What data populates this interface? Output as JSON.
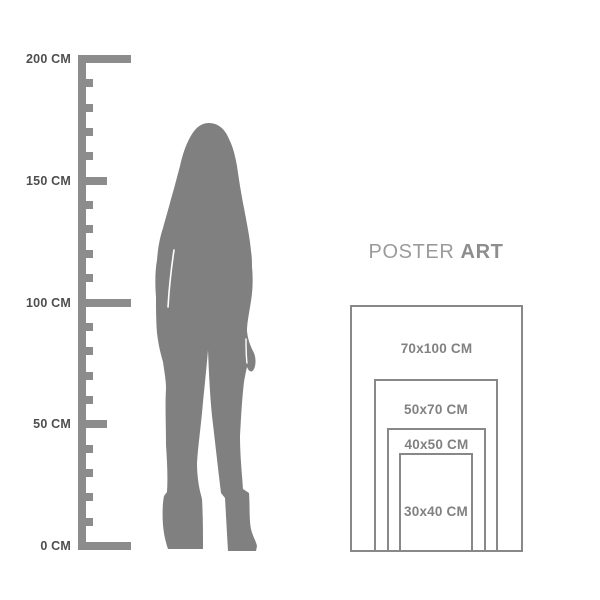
{
  "page": {
    "background": "#ffffff"
  },
  "colors": {
    "silhouette": "#808080",
    "ruler": "#8c8c8c",
    "ruler_label_text": "#4e4e4e",
    "frame_border": "#888888",
    "frame_label_text": "#818181",
    "brand_text": "#9b9b9b"
  },
  "ruler": {
    "unit": "CM",
    "max_cm": 200,
    "minor_step_cm": 10,
    "labels": [
      {
        "cm": 200,
        "text": "200 CM"
      },
      {
        "cm": 150,
        "text": "150 CM"
      },
      {
        "cm": 100,
        "text": "100 CM"
      },
      {
        "cm": 50,
        "text": "50 CM"
      },
      {
        "cm": 0,
        "text": "0 CM"
      }
    ]
  },
  "figure": {
    "icon": "standing-woman-silhouette"
  },
  "brand": {
    "name_regular": "POSTER",
    "name_bold": "ART"
  },
  "size_chart": {
    "sizes": [
      {
        "label": "70x100 CM",
        "width_cm": 70,
        "height_cm": 100
      },
      {
        "label": "50x70 CM",
        "width_cm": 50,
        "height_cm": 70
      },
      {
        "label": "40x50 CM",
        "width_cm": 40,
        "height_cm": 50
      },
      {
        "label": "30x40 CM",
        "width_cm": 30,
        "height_cm": 40
      }
    ]
  }
}
